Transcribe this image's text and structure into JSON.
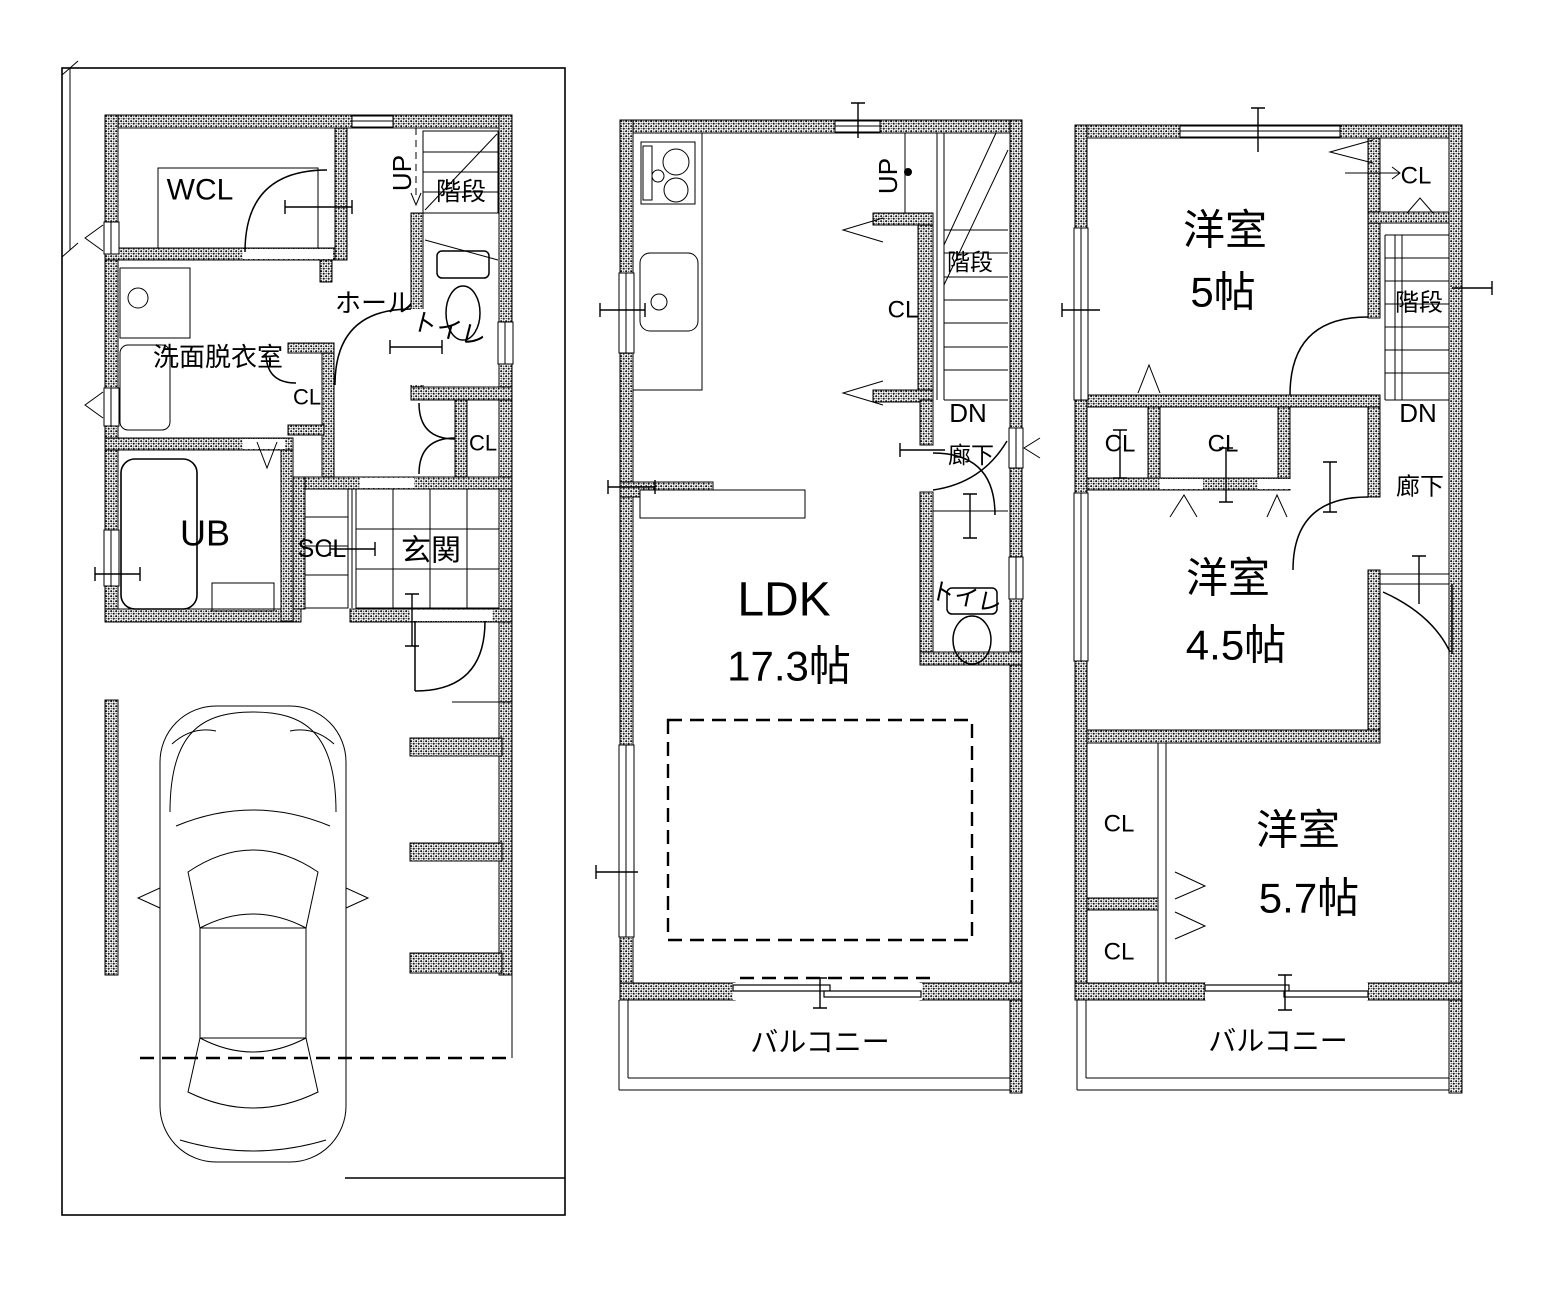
{
  "drawing": {
    "kind": "floor-plan",
    "background": "#ffffff",
    "ink": "#000000",
    "floors": [
      {
        "id": "floor-1",
        "labels": [
          {
            "name": "room-wcl",
            "text": "WCL",
            "x": 200,
            "y": 190,
            "size": 30,
            "rot": 0
          },
          {
            "name": "room-senmen-datsuiishitsu",
            "text": "洗面脱衣室",
            "x": 218,
            "y": 357,
            "size": 26,
            "rot": 0
          },
          {
            "name": "closet-cl-washroom",
            "text": "CL",
            "x": 307,
            "y": 397,
            "size": 22,
            "rot": 0
          },
          {
            "name": "room-hall",
            "text": "ホール",
            "x": 374,
            "y": 303,
            "size": 26,
            "rot": 0
          },
          {
            "name": "stairs-up",
            "text": "UP",
            "x": 402,
            "y": 173,
            "size": 26,
            "rot": -90
          },
          {
            "name": "room-kaidan",
            "text": "階段",
            "x": 461,
            "y": 192,
            "size": 25,
            "rot": 0
          },
          {
            "name": "room-toilet",
            "text": "トイレ",
            "x": 449,
            "y": 330,
            "size": 25,
            "rot": 14
          },
          {
            "name": "closet-cl-hall",
            "text": "CL",
            "x": 483,
            "y": 443,
            "size": 22,
            "rot": 0
          },
          {
            "name": "room-ub",
            "text": "UB",
            "x": 205,
            "y": 533,
            "size": 36,
            "rot": 0
          },
          {
            "name": "closet-scl",
            "text": "SCL",
            "x": 322,
            "y": 549,
            "size": 25,
            "rot": 0
          },
          {
            "name": "room-genkan",
            "text": "玄関",
            "x": 431,
            "y": 551,
            "size": 30,
            "rot": 0
          }
        ]
      },
      {
        "id": "floor-2",
        "labels": [
          {
            "name": "stairs-up",
            "text": "UP",
            "x": 888,
            "y": 176,
            "size": 26,
            "rot": -90
          },
          {
            "name": "room-kaidan",
            "text": "階段",
            "x": 970,
            "y": 262,
            "size": 23,
            "rot": 0
          },
          {
            "name": "closet-cl",
            "text": "CL",
            "x": 903,
            "y": 310,
            "size": 24,
            "rot": 0
          },
          {
            "name": "stairs-dn",
            "text": "DN",
            "x": 968,
            "y": 413,
            "size": 26,
            "rot": 0
          },
          {
            "name": "room-rouka",
            "text": "廊下",
            "x": 971,
            "y": 455,
            "size": 23,
            "rot": 0
          },
          {
            "name": "room-toilet",
            "text": "トイレ",
            "x": 966,
            "y": 598,
            "size": 24,
            "rot": 12
          },
          {
            "name": "room-ldk",
            "text": "LDK",
            "x": 784,
            "y": 600,
            "size": 48,
            "rot": 0
          },
          {
            "name": "room-ldk-size",
            "text": "17.3帖",
            "x": 789,
            "y": 666,
            "size": 42,
            "rot": 0
          },
          {
            "name": "balcony",
            "text": "バルコニー",
            "x": 820,
            "y": 1042,
            "size": 28,
            "rot": 0
          }
        ]
      },
      {
        "id": "floor-3",
        "labels": [
          {
            "name": "room-youshitsu-5",
            "text": "洋室",
            "x": 1225,
            "y": 230,
            "size": 42,
            "rot": 0
          },
          {
            "name": "room-youshitsu-5-size",
            "text": "5帖",
            "x": 1223,
            "y": 292,
            "size": 42,
            "rot": 0
          },
          {
            "name": "closet-cl-top",
            "text": "CL",
            "x": 1416,
            "y": 176,
            "size": 24,
            "rot": 0
          },
          {
            "name": "room-kaidan",
            "text": "階段",
            "x": 1419,
            "y": 303,
            "size": 24,
            "rot": 0
          },
          {
            "name": "stairs-dn",
            "text": "DN",
            "x": 1418,
            "y": 413,
            "size": 26,
            "rot": 0
          },
          {
            "name": "closet-cl-mid-left",
            "text": "CL",
            "x": 1120,
            "y": 444,
            "size": 24,
            "rot": 0
          },
          {
            "name": "closet-cl-mid-center",
            "text": "CL",
            "x": 1223,
            "y": 444,
            "size": 24,
            "rot": 0
          },
          {
            "name": "room-rouka",
            "text": "廊下",
            "x": 1420,
            "y": 487,
            "size": 24,
            "rot": 0
          },
          {
            "name": "room-youshitsu-45",
            "text": "洋室",
            "x": 1228,
            "y": 578,
            "size": 42,
            "rot": 0
          },
          {
            "name": "room-youshitsu-45-size",
            "text": "4.5帖",
            "x": 1236,
            "y": 645,
            "size": 42,
            "rot": 0
          },
          {
            "name": "closet-cl-low-1",
            "text": "CL",
            "x": 1119,
            "y": 824,
            "size": 24,
            "rot": 0
          },
          {
            "name": "closet-cl-low-2",
            "text": "CL",
            "x": 1119,
            "y": 952,
            "size": 24,
            "rot": 0
          },
          {
            "name": "room-youshitsu-57",
            "text": "洋室",
            "x": 1298,
            "y": 830,
            "size": 42,
            "rot": 0
          },
          {
            "name": "room-youshitsu-57-size",
            "text": "5.7帖",
            "x": 1309,
            "y": 898,
            "size": 42,
            "rot": 0
          },
          {
            "name": "balcony",
            "text": "バルコニー",
            "x": 1278,
            "y": 1041,
            "size": 28,
            "rot": 0
          }
        ]
      }
    ]
  }
}
